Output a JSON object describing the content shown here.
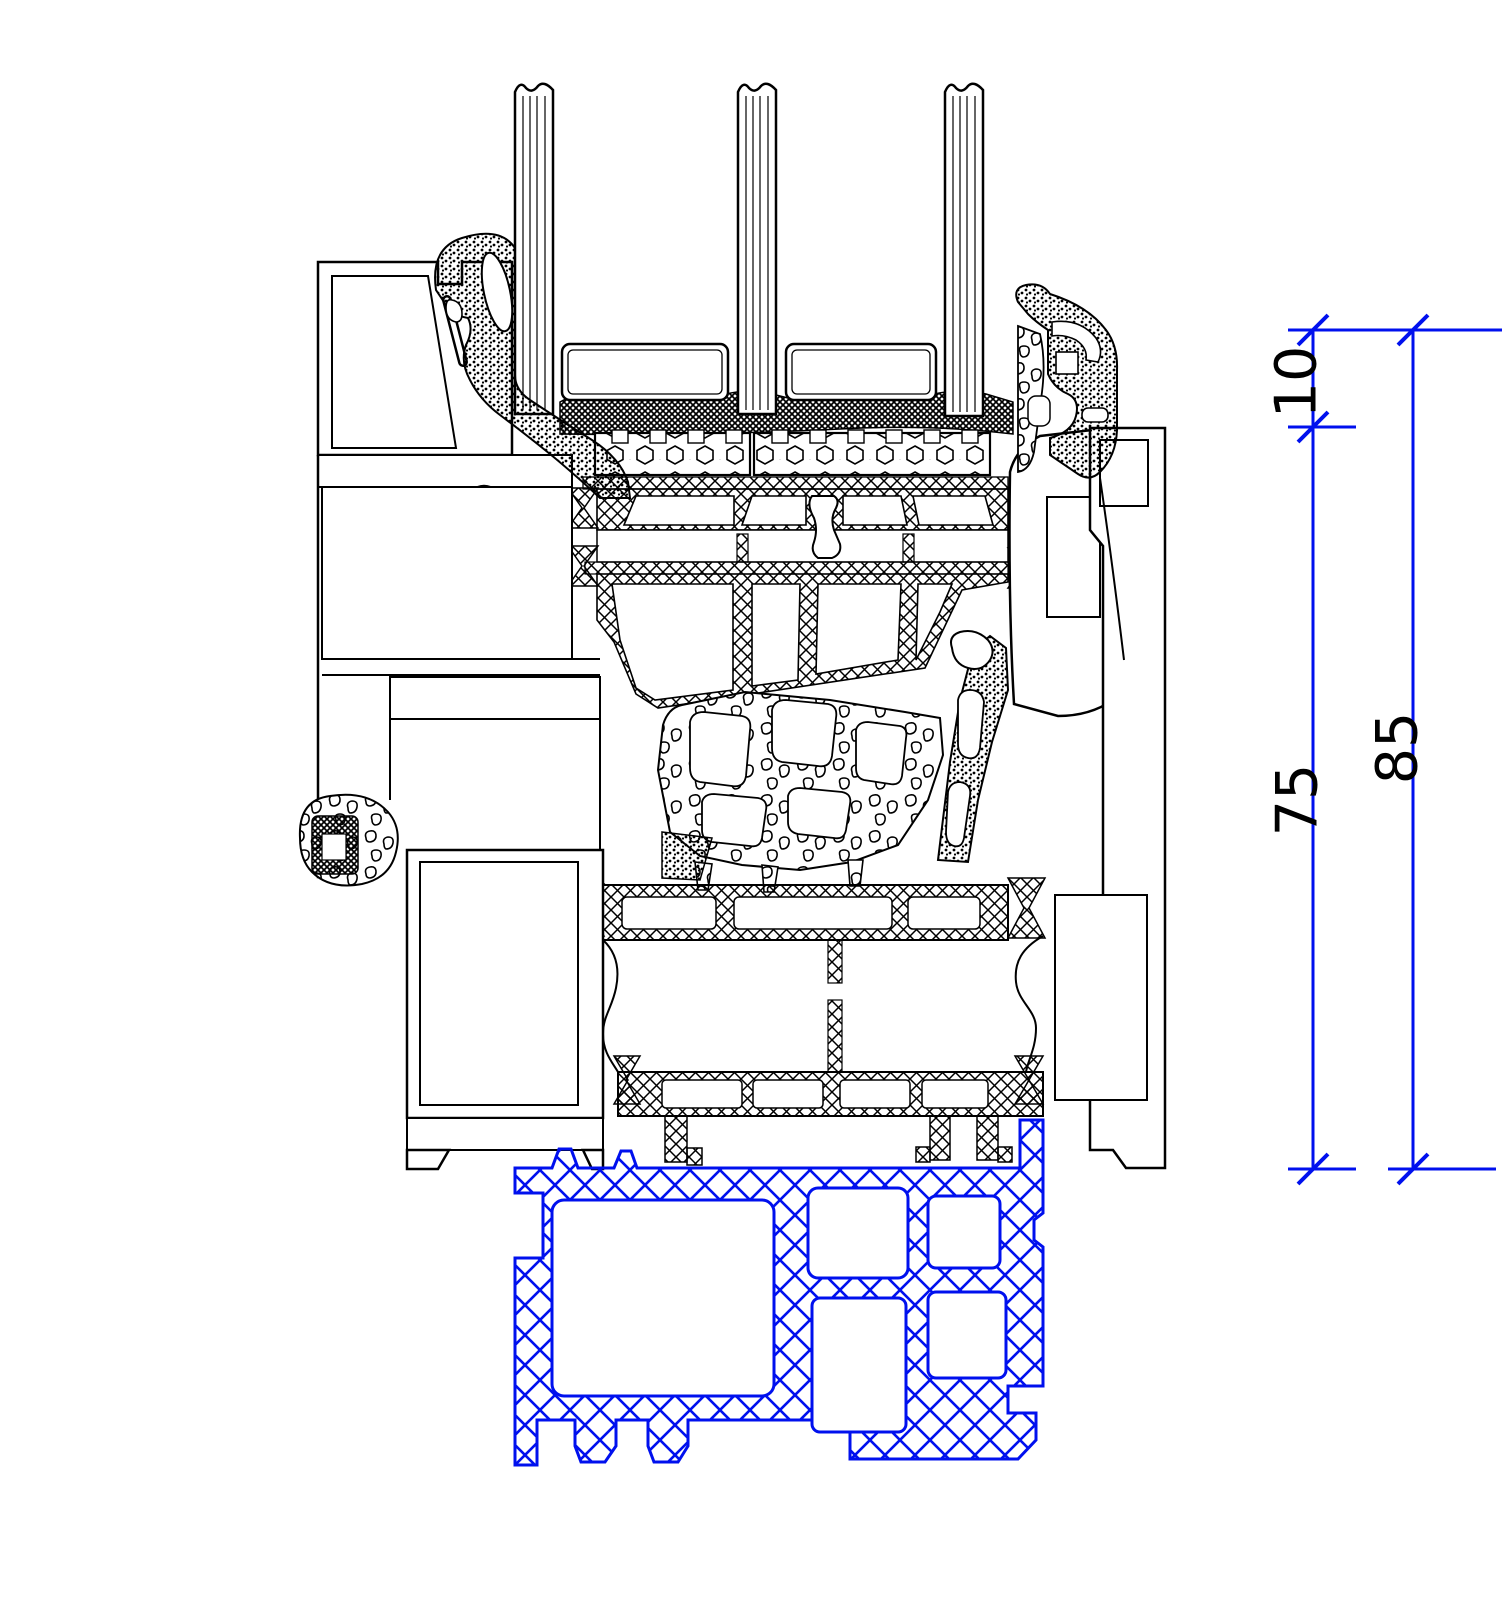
{
  "dimensions": {
    "glazing_offset": {
      "label": "10"
    },
    "frame_height": {
      "label": "75"
    },
    "total_height": {
      "label": "85"
    }
  },
  "colors": {
    "line": "#000000",
    "dimension": "#0010ee",
    "threshold": "#0010ee",
    "paper": "#ffffff"
  }
}
